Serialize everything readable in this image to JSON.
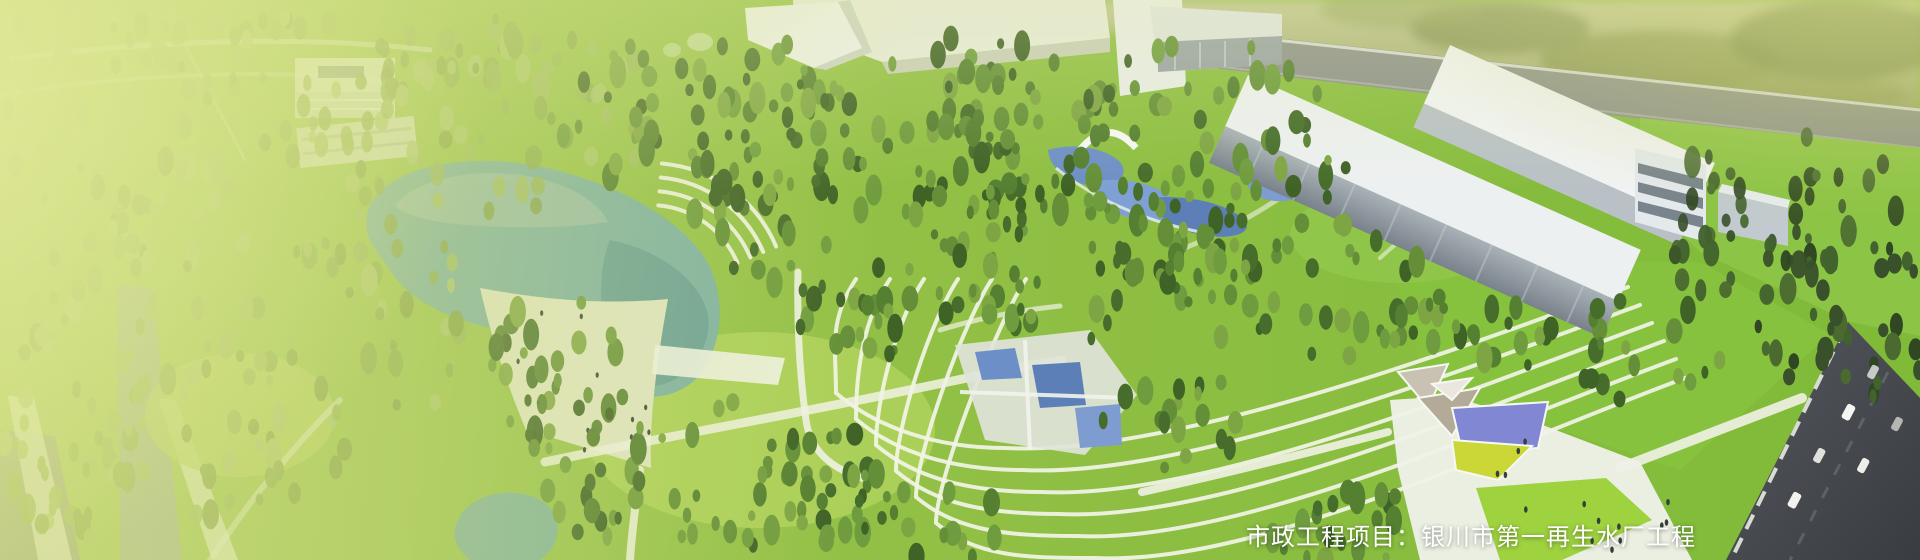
{
  "banner": {
    "caption": "市政工程项目：银川市第一再生水厂工程"
  },
  "theme": {
    "wash_green": "#d7e087",
    "grass_left": "#a6c95c",
    "grass_mid": "#92c046",
    "grass_right": "#7fba38",
    "lawn_bright": "#aed25b",
    "lawn_right": "#86c23d",
    "lake_teal": "#7fb1a4",
    "lake_deep": "#679e97",
    "path_white": "#f0f2e4",
    "building_white": "#eef1ee",
    "building_gray": "#9ba4ab",
    "road_dark": "#46494e",
    "pool_blue": "#6d8fc7",
    "canopy_blue": "#8287d3",
    "canopy_yellow": "#cad736",
    "caption_white": "#ffffff",
    "tree_dark": "#44632a"
  }
}
